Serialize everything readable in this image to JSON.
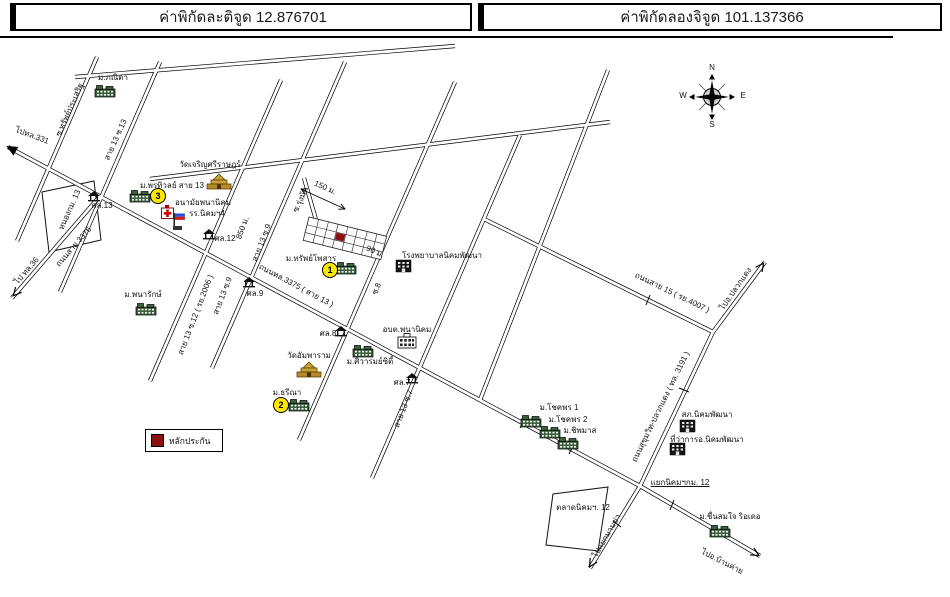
{
  "header": {
    "lat": "ค่าพิกัดละติจูด 12.876701",
    "lng": "ค่าพิกัดลองจิจูด 101.137366"
  },
  "legend": {
    "label": "หลักประกัน",
    "color": "#8b1111"
  },
  "compass": {
    "n": "N",
    "e": "E",
    "s": "S",
    "w": "W"
  },
  "map": {
    "roads": [
      {
        "id": "sai13-main-thl3375",
        "pts": [
          [
            8,
            147
          ],
          [
            640,
            486
          ]
        ]
      },
      {
        "id": "rd-3376",
        "pts": [
          [
            12,
            298
          ],
          [
            100,
            196
          ]
        ]
      },
      {
        "id": "sai15-ry4007",
        "pts": [
          [
            484,
            219
          ],
          [
            713,
            332
          ]
        ]
      },
      {
        "id": "to-pluakdaeng",
        "pts": [
          [
            713,
            332
          ],
          [
            765,
            262
          ]
        ]
      },
      {
        "id": "thl3191-sukhumvit-pluakdaeng",
        "pts": [
          [
            713,
            332
          ],
          [
            640,
            486
          ]
        ]
      },
      {
        "id": "to-mapkha",
        "pts": [
          [
            640,
            486
          ],
          [
            590,
            568
          ]
        ]
      },
      {
        "id": "to-bankhai",
        "pts": [
          [
            640,
            486
          ],
          [
            760,
            556
          ]
        ]
      },
      {
        "id": "soi-sapprasert",
        "pts": [
          [
            97,
            57
          ],
          [
            17,
            241
          ]
        ]
      },
      {
        "id": "sai13-soi13",
        "pts": [
          [
            160,
            62
          ],
          [
            60,
            292
          ]
        ]
      },
      {
        "id": "sai13-soi12-ry2006",
        "pts": [
          [
            281,
            80
          ],
          [
            150,
            381
          ]
        ]
      },
      {
        "id": "sai13-soi9",
        "pts": [
          [
            345,
            62
          ],
          [
            212,
            368
          ]
        ]
      },
      {
        "id": "sai13-soi8",
        "pts": [
          [
            455,
            82
          ],
          [
            299,
            440
          ]
        ]
      },
      {
        "id": "sai13-soi7",
        "pts": [
          [
            520,
            135
          ],
          [
            372,
            478
          ]
        ]
      },
      {
        "id": "soi-upper-right",
        "pts": [
          [
            608,
            70
          ],
          [
            480,
            400
          ]
        ]
      },
      {
        "id": "top-road-a",
        "pts": [
          [
            75,
            77
          ],
          [
            455,
            46
          ]
        ]
      },
      {
        "id": "top-road-b",
        "pts": [
          [
            150,
            179
          ],
          [
            610,
            122
          ]
        ]
      },
      {
        "id": "soi-rungmat-stub",
        "pts": [
          [
            304,
            178
          ],
          [
            316,
            220
          ]
        ]
      }
    ],
    "ticks": [
      {
        "x1": 520,
        "y1": 428,
        "x2": 525,
        "y2": 418
      },
      {
        "x1": 569,
        "y1": 454,
        "x2": 574,
        "y2": 444
      },
      {
        "x1": 646,
        "y1": 305,
        "x2": 650,
        "y2": 295
      },
      {
        "x1": 679,
        "y1": 388,
        "x2": 689,
        "y2": 392
      },
      {
        "x1": 670,
        "y1": 510,
        "x2": 674,
        "y2": 500
      },
      {
        "x1": 613,
        "y1": 521,
        "x2": 621,
        "y2": 527
      }
    ],
    "arrows": [
      {
        "type": "filled",
        "x": 8,
        "y": 147,
        "a": -151.8
      },
      {
        "type": "open",
        "x": 14,
        "y": 295,
        "a": 130.8
      },
      {
        "type": "open",
        "x": 763,
        "y": 264,
        "a": -53.4
      },
      {
        "type": "open",
        "x": 590,
        "y": 566,
        "a": 121.4
      },
      {
        "type": "open",
        "x": 758,
        "y": 555,
        "a": 30.3
      }
    ],
    "measures": [
      {
        "x1": 301,
        "y1": 189,
        "x2": 345,
        "y2": 209,
        "heads": 2
      },
      {
        "x1": 363,
        "y1": 242,
        "x2": 371,
        "y2": 249,
        "heads": 1
      }
    ],
    "pond": "42,192 94,181 101,240 49,252",
    "market": "553,494 608,487 598,551 546,545",
    "grid": {
      "x": 309,
      "y": 217,
      "rot": 14,
      "cols": 8,
      "rows": 3,
      "cw": 10,
      "ch": 8,
      "red": {
        "c": 3,
        "r": 1
      },
      "redColor": "#8b1111"
    },
    "labels": [
      {
        "id": "to-thl331",
        "t": "ไปทล.331",
        "x": 32,
        "y": 136,
        "r": 20
      },
      {
        "id": "m-phanita",
        "t": "ม.ภณิตา",
        "x": 113,
        "y": 78,
        "r": 0
      },
      {
        "id": "soi-sapprasert",
        "t": "ซ.ทรัพย์ประเสริฐ",
        "x": 70,
        "y": 110,
        "r": -66
      },
      {
        "id": "sai13-soi13",
        "t": "สาย 13 ซ.13",
        "x": 116,
        "y": 140,
        "r": -66
      },
      {
        "id": "wat-charoensri",
        "t": "วัดเจริญศรีราษฎร์",
        "x": 210,
        "y": 165,
        "r": 0
      },
      {
        "id": "m-porntiwan",
        "t": "ม.พรทิวลย์ สาย 13",
        "x": 172,
        "y": 186,
        "r": 0
      },
      {
        "id": "anamai-phananikhom",
        "t": "อนามัยพนานิคม",
        "x": 203,
        "y": 203,
        "r": 0
      },
      {
        "id": "school-nikhom4",
        "t": "รร.นิคมฯ4",
        "x": 207,
        "y": 214,
        "r": 0
      },
      {
        "id": "sala13",
        "t": "ศล.13",
        "x": 102,
        "y": 206,
        "r": 0
      },
      {
        "id": "sala12",
        "t": "ศล.12",
        "x": 225,
        "y": 239,
        "r": 0
      },
      {
        "id": "pond-km13",
        "t": "หนองกม. 13",
        "x": 70,
        "y": 210,
        "r": -66
      },
      {
        "id": "rd-3376",
        "t": "ถนนสาย 3376",
        "x": 74,
        "y": 247,
        "r": -49
      },
      {
        "id": "to-thl36",
        "t": "ไป ทล.36",
        "x": 27,
        "y": 271,
        "r": -49
      },
      {
        "id": "m-panarak",
        "t": "ม.พนารักษ์",
        "x": 143,
        "y": 295,
        "r": 0
      },
      {
        "id": "sai13-soi12",
        "t": "สาย 13 ซ.12 ( รย.2006 )",
        "x": 196,
        "y": 315,
        "r": -69
      },
      {
        "id": "sai13-soi9-a",
        "t": "สาย 13 ซ.9",
        "x": 262,
        "y": 243,
        "r": -69
      },
      {
        "id": "dist-850",
        "t": "850 ม.",
        "x": 243,
        "y": 228,
        "r": -69
      },
      {
        "id": "sai13-soi9-b",
        "t": "สาย 13 ซ.9",
        "x": 223,
        "y": 296,
        "r": -69
      },
      {
        "id": "sala9",
        "t": "ศล.9",
        "x": 255,
        "y": 294,
        "r": 0
      },
      {
        "id": "rd-thl3375",
        "t": "ถนนทล.3375 ( สาย 13 )",
        "x": 296,
        "y": 286,
        "r": 28
      },
      {
        "id": "dist-150",
        "t": "150 ม.",
        "x": 325,
        "y": 188,
        "r": 24
      },
      {
        "id": "soi-rungmat",
        "t": "ซ.รุ่งมัด",
        "x": 301,
        "y": 200,
        "r": -66
      },
      {
        "id": "dist-90",
        "t": "90 ม.",
        "x": 375,
        "y": 252,
        "r": 24
      },
      {
        "id": "m-sapphosan",
        "t": "ม.ทรัพย์โพสาร",
        "x": 311,
        "y": 259,
        "r": 0
      },
      {
        "id": "hospital",
        "t": "โรงพยาบาลนิคมพัฒนา",
        "x": 442,
        "y": 256,
        "r": 0
      },
      {
        "id": "sala8",
        "t": "ศล.8",
        "x": 328,
        "y": 334,
        "r": 0
      },
      {
        "id": "soi8",
        "t": "ซ.8",
        "x": 377,
        "y": 289,
        "r": -69
      },
      {
        "id": "obt-phananikhom",
        "t": "อบต.พนานิคม",
        "x": 407,
        "y": 330,
        "r": 0
      },
      {
        "id": "wat-amphawaram",
        "t": "วัดอัมพาราม",
        "x": 309,
        "y": 356,
        "r": 0
      },
      {
        "id": "m-siwarom",
        "t": "ม.ศิวารมย์ซิตี้",
        "x": 370,
        "y": 362,
        "r": 0
      },
      {
        "id": "sala7",
        "t": "ศล.7",
        "x": 402,
        "y": 383,
        "r": 0
      },
      {
        "id": "sai13-soi7",
        "t": "สาย 13 ซ.7",
        "x": 404,
        "y": 409,
        "r": -69
      },
      {
        "id": "m-threena",
        "t": "ม.ธรีณา",
        "x": 287,
        "y": 393,
        "r": 0
      },
      {
        "id": "rd-sai15",
        "t": "ถนนสาย 15 ( รย.4007 )",
        "x": 672,
        "y": 293,
        "r": 26
      },
      {
        "id": "to-pluakdaeng",
        "t": "ไปอ.ปลวกแดง",
        "x": 736,
        "y": 289,
        "r": -55
      },
      {
        "id": "rd-thl3191",
        "t": "ถนนสุขุมวิท-ปลวกแดง ( ทล. 3191 )",
        "x": 661,
        "y": 407,
        "r": -64
      },
      {
        "id": "m-chokphon1",
        "t": "ม.โชคพร 1",
        "x": 559,
        "y": 408,
        "r": 0
      },
      {
        "id": "m-chokphon2",
        "t": "ม.โชคพร 2",
        "x": 568,
        "y": 420,
        "r": 0
      },
      {
        "id": "m-chipamas",
        "t": "ม.ชิพมาส",
        "x": 580,
        "y": 431,
        "r": 0
      },
      {
        "id": "police-nikhomphatthana",
        "t": "สภ.นิคมพัฒนา",
        "x": 707,
        "y": 415,
        "r": 0
      },
      {
        "id": "district-office",
        "t": "ที่ว่าการอ.นิคมพัฒนา",
        "x": 707,
        "y": 440,
        "r": 0
      },
      {
        "id": "junction-km12",
        "t": "แยกนิคมฯกม. 12",
        "x": 680,
        "y": 483,
        "r": 0,
        "u": true
      },
      {
        "id": "market-km12",
        "t": "ตลาดนิคมฯ. 12",
        "x": 583,
        "y": 508,
        "r": 0
      },
      {
        "id": "to-mapkha",
        "t": "ไปแยกมาบข่า",
        "x": 607,
        "y": 536,
        "r": -60
      },
      {
        "id": "to-bankhai",
        "t": "ไปอ.บ้านค่าย",
        "x": 722,
        "y": 562,
        "r": 27
      },
      {
        "id": "m-chuensomjai",
        "t": "ม.ชื่นสมใจ ริอเดอ",
        "x": 730,
        "y": 517,
        "r": 0
      },
      {
        "id": "compass-n",
        "t": "N",
        "x": 712,
        "y": 68,
        "r": 0
      },
      {
        "id": "compass-s",
        "t": "S",
        "x": 712,
        "y": 125,
        "r": 0
      },
      {
        "id": "compass-w",
        "t": "W",
        "x": 683,
        "y": 96,
        "r": 0
      },
      {
        "id": "compass-e",
        "t": "E",
        "x": 743,
        "y": 96,
        "r": 0
      }
    ],
    "icons": [
      {
        "id": "m-phanita",
        "k": "village",
        "x": 95,
        "y": 84
      },
      {
        "id": "wat-charoensri",
        "k": "temple",
        "x": 206,
        "y": 174
      },
      {
        "id": "m-porntiwan",
        "k": "village",
        "x": 130,
        "y": 189
      },
      {
        "id": "anamai",
        "k": "cross",
        "x": 161,
        "y": 205
      },
      {
        "id": "school-nikhom4",
        "k": "flag",
        "x": 173,
        "y": 213
      },
      {
        "id": "sala13",
        "k": "pavilion",
        "x": 88,
        "y": 191
      },
      {
        "id": "sala12",
        "k": "pavilion",
        "x": 203,
        "y": 229
      },
      {
        "id": "sala9",
        "k": "pavilion",
        "x": 243,
        "y": 277
      },
      {
        "id": "sala8",
        "k": "pavilion",
        "x": 335,
        "y": 326
      },
      {
        "id": "sala7",
        "k": "pavilion",
        "x": 406,
        "y": 373
      },
      {
        "id": "m-panarak",
        "k": "village",
        "x": 136,
        "y": 302
      },
      {
        "id": "m-sapphosan",
        "k": "village",
        "x": 336,
        "y": 261
      },
      {
        "id": "hospital",
        "k": "dark",
        "x": 396,
        "y": 260
      },
      {
        "id": "wat-amphawaram",
        "k": "temple",
        "x": 296,
        "y": 362
      },
      {
        "id": "m-siwarom",
        "k": "village",
        "x": 353,
        "y": 344
      },
      {
        "id": "obt",
        "k": "govt",
        "x": 396,
        "y": 333
      },
      {
        "id": "m-threena",
        "k": "village",
        "x": 289,
        "y": 398
      },
      {
        "id": "m-chokphon1",
        "k": "village",
        "x": 521,
        "y": 414
      },
      {
        "id": "m-chokphon2",
        "k": "village",
        "x": 540,
        "y": 425
      },
      {
        "id": "m-chipamas",
        "k": "village",
        "x": 558,
        "y": 436
      },
      {
        "id": "police",
        "k": "dark",
        "x": 680,
        "y": 420
      },
      {
        "id": "district-office",
        "k": "dark",
        "x": 670,
        "y": 443
      },
      {
        "id": "m-chuensomjai",
        "k": "village",
        "x": 710,
        "y": 524
      }
    ],
    "markers": [
      {
        "id": "marker-1",
        "n": "1",
        "x": 330,
        "y": 270
      },
      {
        "id": "marker-2",
        "n": "2",
        "x": 281,
        "y": 405
      },
      {
        "id": "marker-3",
        "n": "3",
        "x": 158,
        "y": 196
      }
    ]
  }
}
